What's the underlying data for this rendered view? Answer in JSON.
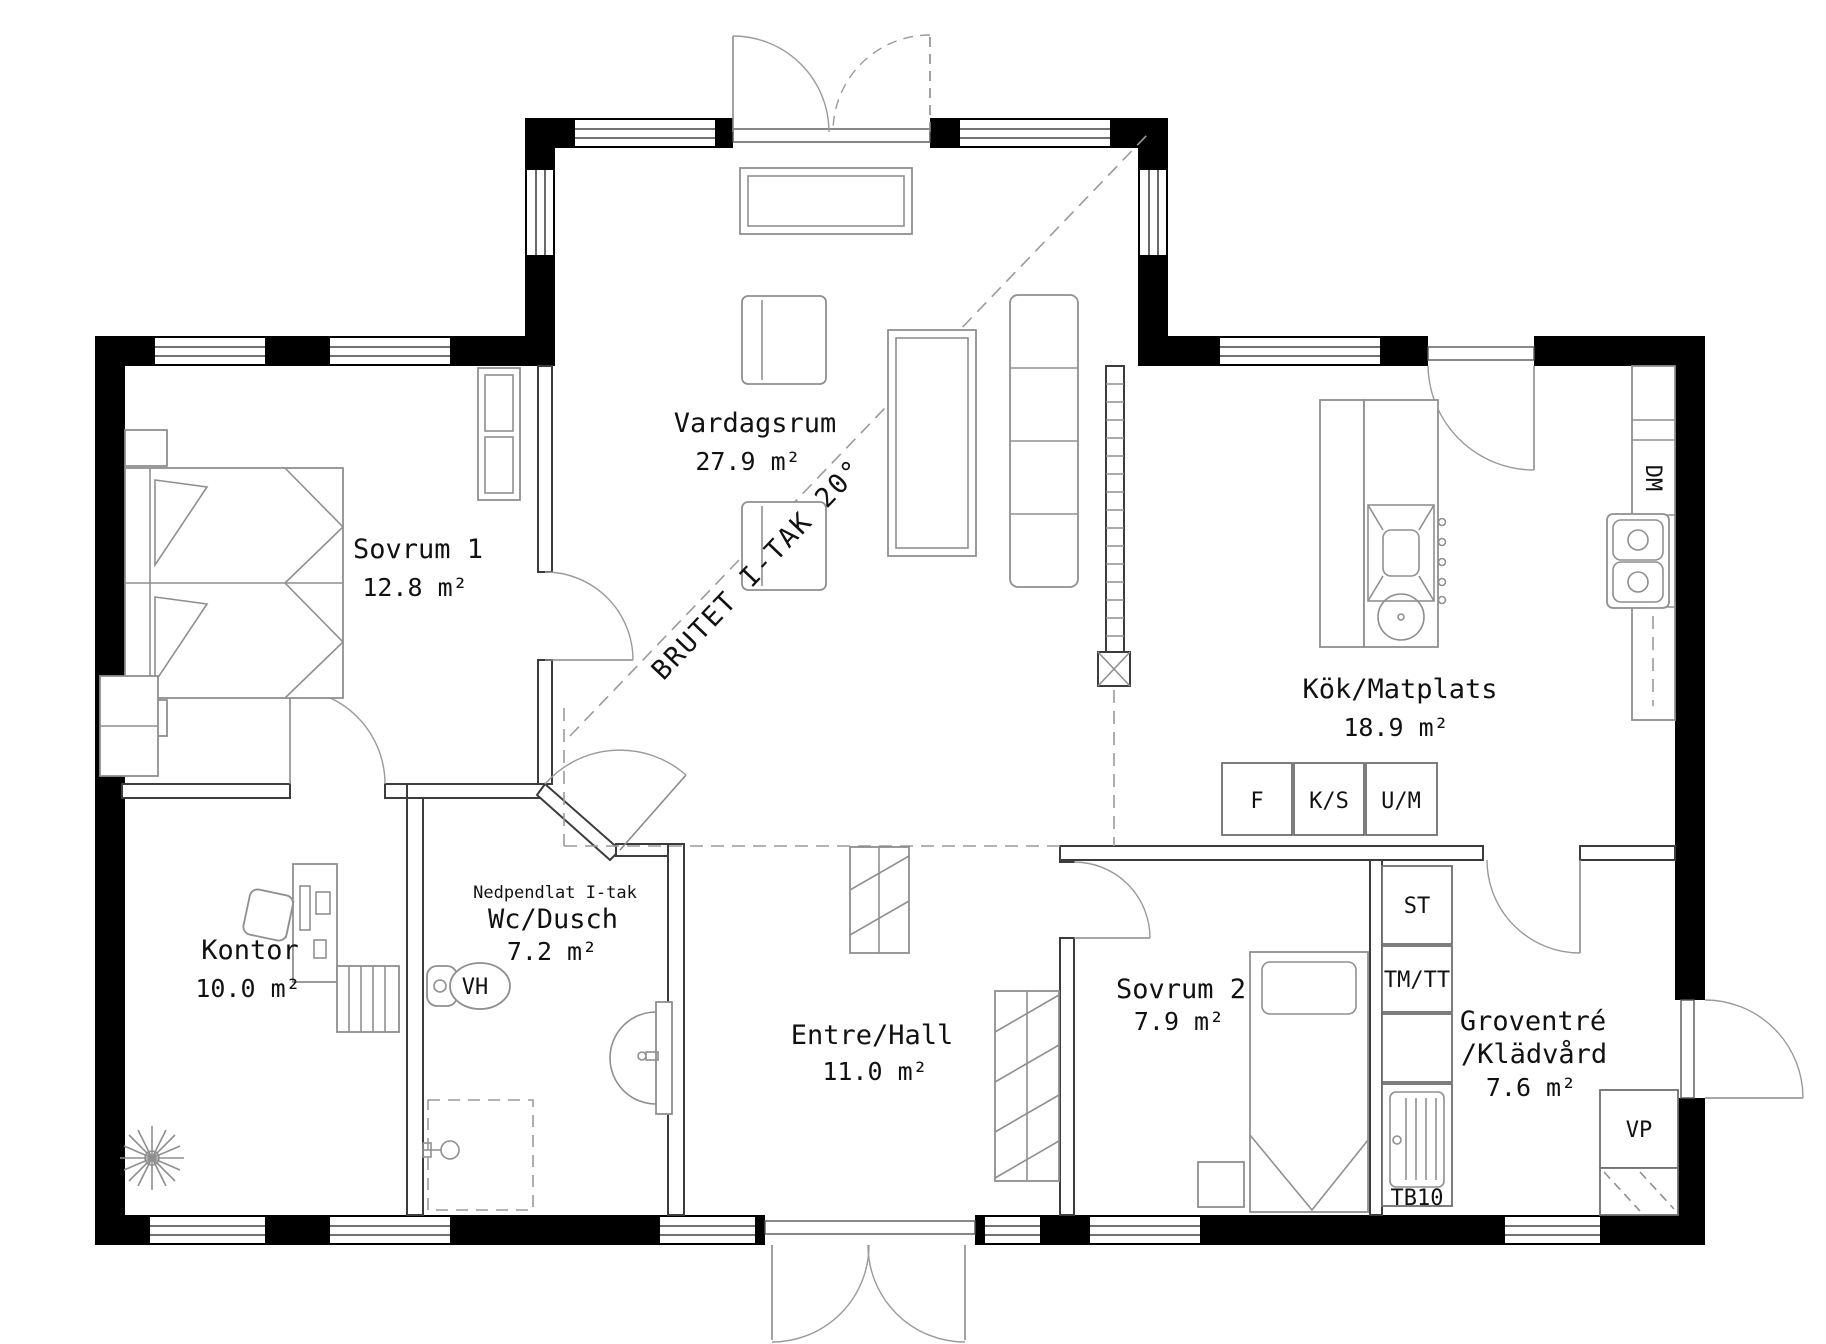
{
  "document": {
    "type": "architectural floor plan"
  },
  "rooms": {
    "vardagsrum": {
      "name": "Vardagsrum",
      "area": "27.9 m²"
    },
    "sovrum1": {
      "name": "Sovrum 1",
      "area": "12.8 m²"
    },
    "kok": {
      "name": "Kök/Matplats",
      "area": "18.9 m²"
    },
    "kontor": {
      "name": "Kontor",
      "area": "10.0 m²"
    },
    "wc": {
      "ceiling_note": "Nedpendlat I-tak",
      "name": "Wc/Dusch",
      "area": "7.2 m²"
    },
    "entre": {
      "name": "Entre/Hall",
      "area": "11.0 m²"
    },
    "sovrum2": {
      "name": "Sovrum 2",
      "area": "7.9 m²"
    },
    "groventre": {
      "name_line1": "Groventré",
      "name_line2": "/Klädvård",
      "area": "7.6 m²"
    }
  },
  "annotations": {
    "ceiling_break": "BRUTET I-TAK 20°"
  },
  "fixtures": {
    "vh": "VH",
    "dm": "DM",
    "fridge": "F",
    "ks": "K/S",
    "um": "U/M",
    "st": "ST",
    "tmtt": "TM/TT",
    "tb10": "TB10",
    "vp": "VP"
  },
  "colors": {
    "wall": "#000000",
    "thin_line": "#8f8f8f",
    "text": "#111111"
  }
}
